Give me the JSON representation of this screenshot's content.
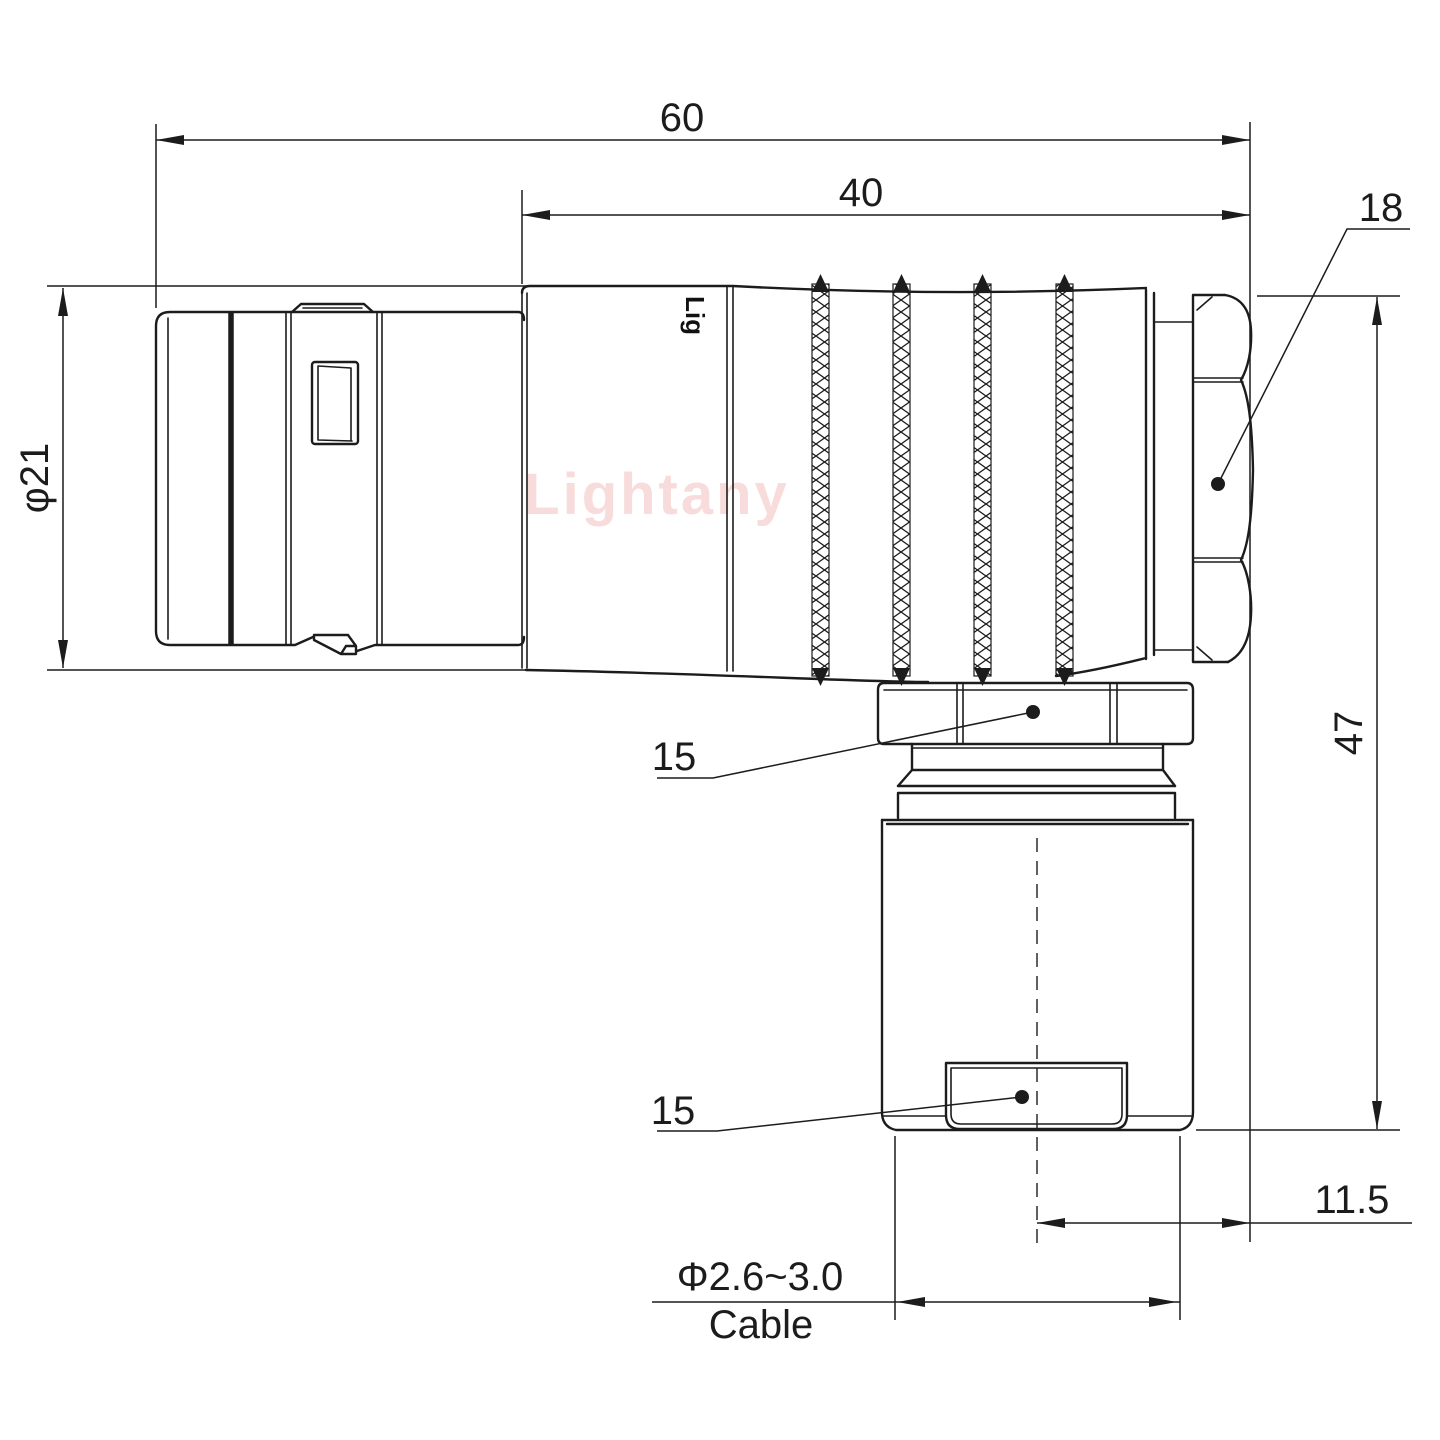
{
  "watermark": "Lightany",
  "body_mark": "Lig",
  "labels": {
    "overall_length": "60",
    "rear_length": "40",
    "nut_width": "18",
    "shell_diameter": "φ21",
    "total_height": "47",
    "elbow_nut_size": "15",
    "cable_nut_size": "15",
    "side_offset": "11.5",
    "cable_diameter": "Φ2.6~3.0",
    "cable_word": "Cable"
  }
}
